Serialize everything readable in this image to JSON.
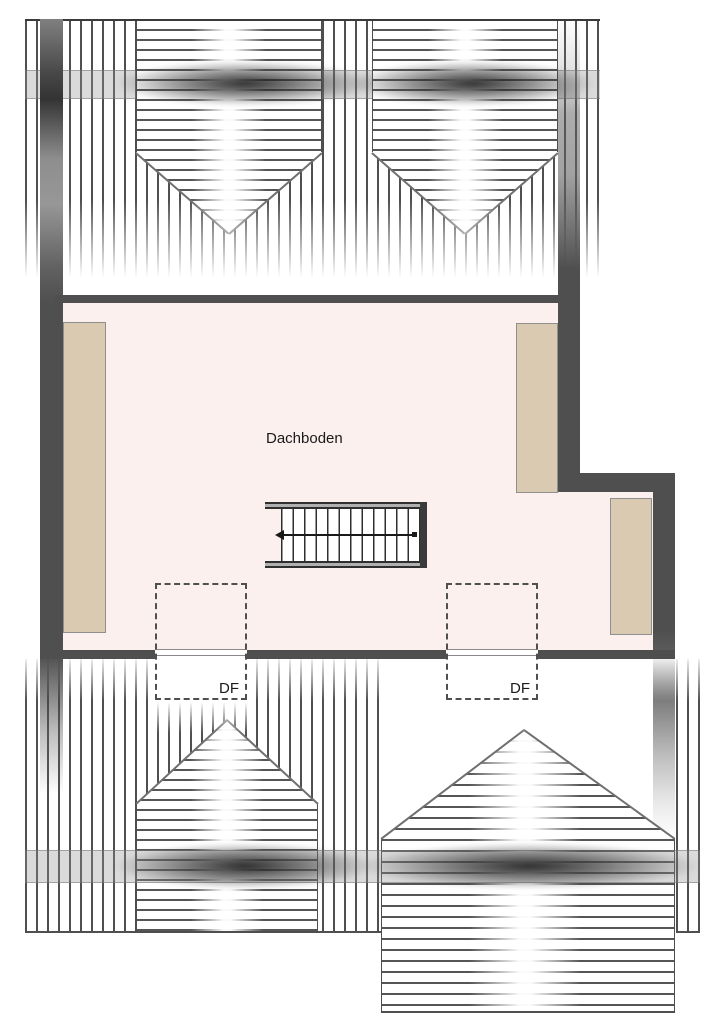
{
  "plan": {
    "room": {
      "label": "Dachboden"
    },
    "roof_windows": [
      {
        "label": "DF"
      },
      {
        "label": "DF"
      }
    ],
    "colors": {
      "wall": "#4f4f4f",
      "floor_fill": "#fcf0ee",
      "knee_wall_fill": "#d9cab1",
      "hatch_line": "#555555",
      "label_text": "#1a1a1a"
    }
  }
}
